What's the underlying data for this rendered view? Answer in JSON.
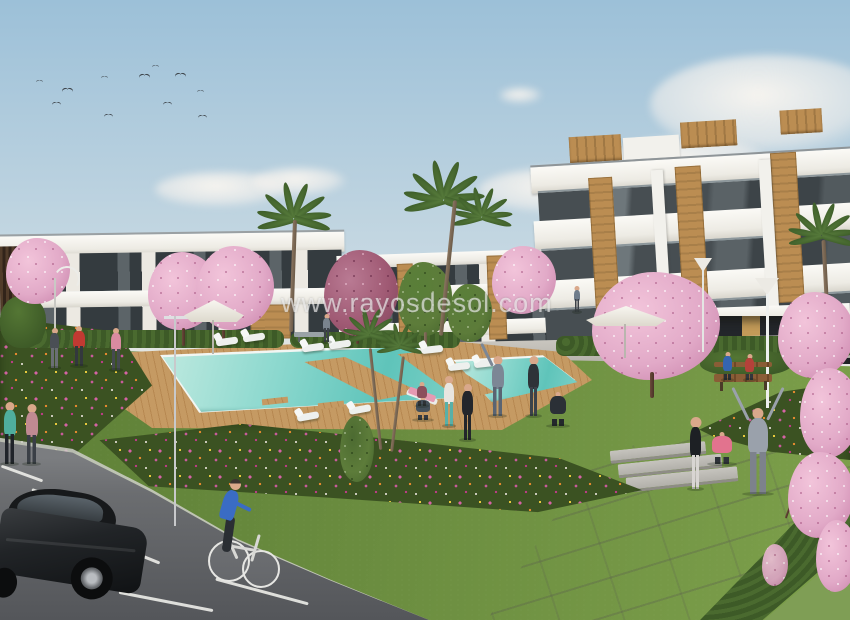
{
  "watermark": {
    "text": "www.rayosdesol.com"
  },
  "colors": {
    "sky_top": "#9cc0d8",
    "sky_mid": "#c6d8e2",
    "sky_horizon": "#e8e8e2",
    "building_white": "#f5f4ef",
    "glass": "#3e4549",
    "glass_light": "#6e777b",
    "wood": "#bb8d52",
    "deck": "#c59a63",
    "grass": "#6a8c3f",
    "grass_light": "#7da04b",
    "water": "#8ed9cf",
    "water_light": "#c4ebe1",
    "water_deep": "#5fc4ba",
    "road": "#6b6d70",
    "path": "#b8b6b0",
    "hedge": "#3d5a27",
    "blossom": "#e2aac8",
    "blossom_deep": "#c57da6",
    "flower_base": "#3b5222",
    "skin": "#d9a88b"
  },
  "scene": {
    "birds": [
      [
        35,
        78
      ],
      [
        52,
        100
      ],
      [
        63,
        86
      ],
      [
        100,
        74
      ],
      [
        104,
        112
      ],
      [
        140,
        72
      ],
      [
        151,
        63
      ],
      [
        163,
        100
      ],
      [
        176,
        71
      ],
      [
        196,
        88
      ],
      [
        198,
        113
      ]
    ],
    "clouds": [
      [
        650,
        55,
        240,
        100
      ],
      [
        598,
        138,
        175,
        55
      ],
      [
        478,
        168,
        165,
        45
      ],
      [
        155,
        172,
        135,
        35
      ],
      [
        252,
        168,
        95,
        28
      ],
      [
        500,
        88,
        42,
        15
      ],
      [
        788,
        165,
        125,
        48
      ]
    ],
    "parking_lines": [
      [
        0,
        472,
        44,
        20
      ],
      [
        30,
        498,
        56,
        21
      ],
      [
        100,
        550,
        62,
        22
      ],
      [
        118,
        600,
        96,
        11
      ],
      [
        214,
        590,
        96,
        15
      ]
    ],
    "loungers": [
      [
        216,
        338,
        -8
      ],
      [
        243,
        334,
        -8
      ],
      [
        302,
        344,
        -8
      ],
      [
        329,
        341,
        -8
      ],
      [
        421,
        346,
        -6
      ],
      [
        448,
        363,
        -6
      ],
      [
        474,
        360,
        -6
      ],
      [
        297,
        413,
        -10
      ],
      [
        349,
        406,
        -10
      ]
    ],
    "people": [
      {
        "name": "jogger-teal",
        "x": 2,
        "y": 402,
        "w": 15,
        "h": 62,
        "top": "#4fae9d",
        "bottom": "#20242a"
      },
      {
        "name": "jogger-pink",
        "x": 24,
        "y": 404,
        "w": 15,
        "h": 60,
        "top": "#c08a92",
        "bottom": "#3a3f46"
      },
      {
        "name": "poolside-walker-dark",
        "x": 49,
        "y": 328,
        "w": 11,
        "h": 40,
        "top": "#4a4f55",
        "bottom": "#6b6f74"
      },
      {
        "name": "poolside-walker-red",
        "x": 72,
        "y": 326,
        "w": 14,
        "h": 40,
        "top": "#c23a32",
        "bottom": "#33383d"
      },
      {
        "name": "poolside-walker-pink",
        "x": 110,
        "y": 328,
        "w": 12,
        "h": 42,
        "top": "#d98ba0",
        "bottom": "#454a50"
      },
      {
        "name": "background-walker",
        "x": 573,
        "y": 286,
        "w": 8,
        "h": 26,
        "top": "#6f7d8c",
        "bottom": "#3c4148"
      },
      {
        "name": "walkway-stander",
        "x": 322,
        "y": 314,
        "w": 9,
        "h": 28,
        "top": "#7a848e",
        "bottom": "#3e434a"
      },
      {
        "name": "exerciser-white-teal",
        "x": 443,
        "y": 376,
        "w": 12,
        "h": 50,
        "top": "#e8e5e0",
        "bottom": "#58b0a8"
      },
      {
        "name": "exerciser-black",
        "x": 461,
        "y": 384,
        "w": 13,
        "h": 56,
        "top": "#23262b",
        "bottom": "#23262b"
      },
      {
        "name": "exerciser-gray",
        "x": 490,
        "y": 356,
        "w": 15,
        "h": 60,
        "top": "#7c8795",
        "bottom": "#5a6472",
        "pose": "arm-up"
      },
      {
        "name": "exerciser-dark",
        "x": 527,
        "y": 356,
        "w": 13,
        "h": 60,
        "top": "#2e3338",
        "bottom": "#3c424a"
      },
      {
        "name": "meditating-person",
        "x": 548,
        "y": 392,
        "w": 20,
        "h": 34,
        "top": "#2b3036",
        "bottom": "#23272c",
        "sit": true
      },
      {
        "name": "lounger-sitter",
        "x": 414,
        "y": 396,
        "w": 18,
        "h": 24,
        "top": "#44505a",
        "bottom": "#333a42",
        "sit": true
      },
      {
        "name": "deckchair-sitter",
        "x": 416,
        "y": 382,
        "w": 12,
        "h": 24,
        "top": "#8c4f5c",
        "bottom": "#2e3236",
        "sit": true
      },
      {
        "name": "path-stander",
        "x": 689,
        "y": 417,
        "w": 13,
        "h": 72,
        "top": "#1d2024",
        "bottom": "#d8d5d2"
      },
      {
        "name": "path-sitter",
        "x": 710,
        "y": 432,
        "w": 24,
        "h": 32,
        "top": "#e2738e",
        "bottom": "#2e3238",
        "sit": true
      },
      {
        "name": "path-stretcher",
        "x": 745,
        "y": 408,
        "w": 26,
        "h": 86,
        "top": "#9aa1ab",
        "bottom": "#7d828c",
        "pose": "arms-up"
      },
      {
        "name": "bench-sitter-blue",
        "x": 722,
        "y": 352,
        "w": 11,
        "h": 28,
        "top": "#3565b0",
        "bottom": "#2b2f35",
        "sit": true
      },
      {
        "name": "bench-sitter-red",
        "x": 744,
        "y": 354,
        "w": 11,
        "h": 26,
        "top": "#b5413a",
        "bottom": "#32363c",
        "sit": true
      }
    ]
  }
}
